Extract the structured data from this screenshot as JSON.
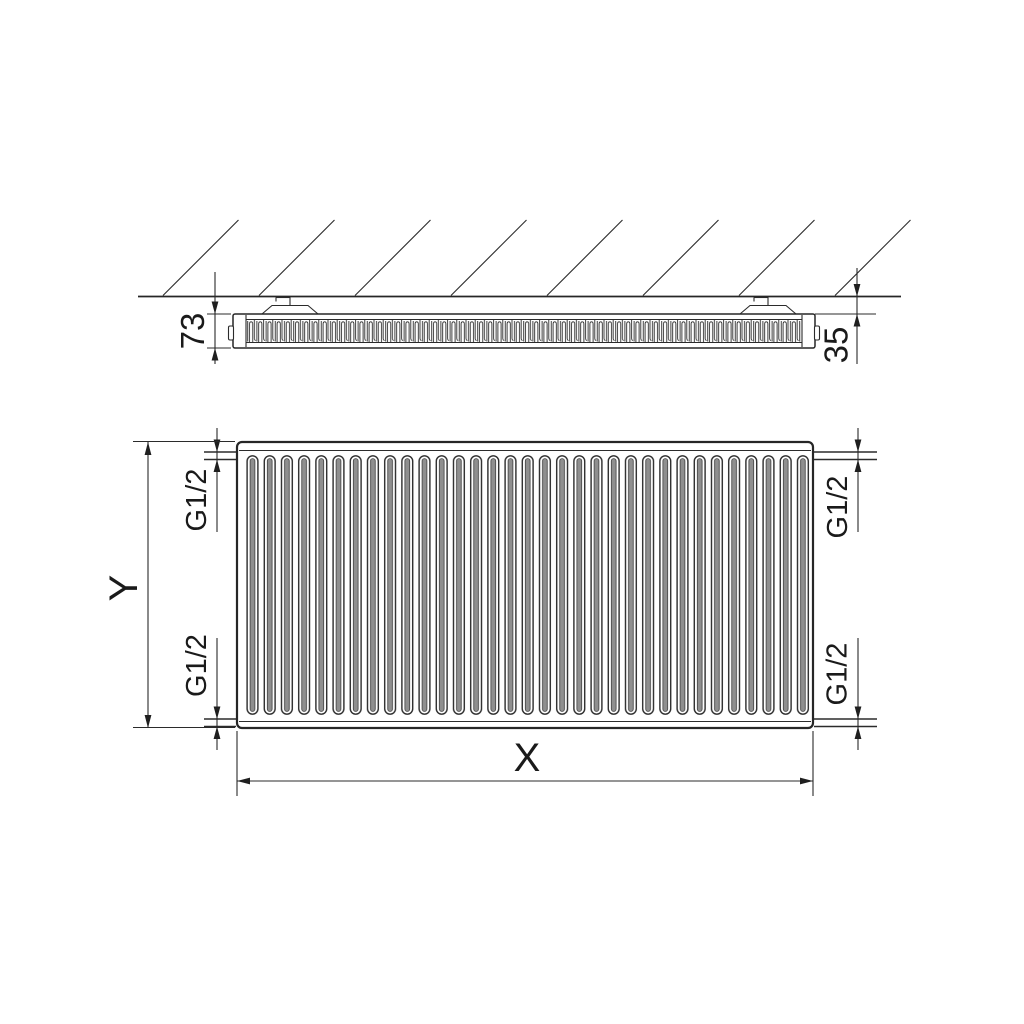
{
  "drawing": {
    "title": "panel-radiator-dimension-drawing",
    "labels": {
      "depth": "73",
      "wall_distance": "35",
      "width_label": "X",
      "height_label": "Y",
      "connections": {
        "top_left": "G1/2",
        "top_right": "G1/2",
        "bottom_left": "G1/2",
        "bottom_right": "G1/2"
      }
    },
    "colors": {
      "line": "#2b2b2b",
      "background": "#ffffff",
      "groove_shade": "#8f8f8f"
    }
  }
}
